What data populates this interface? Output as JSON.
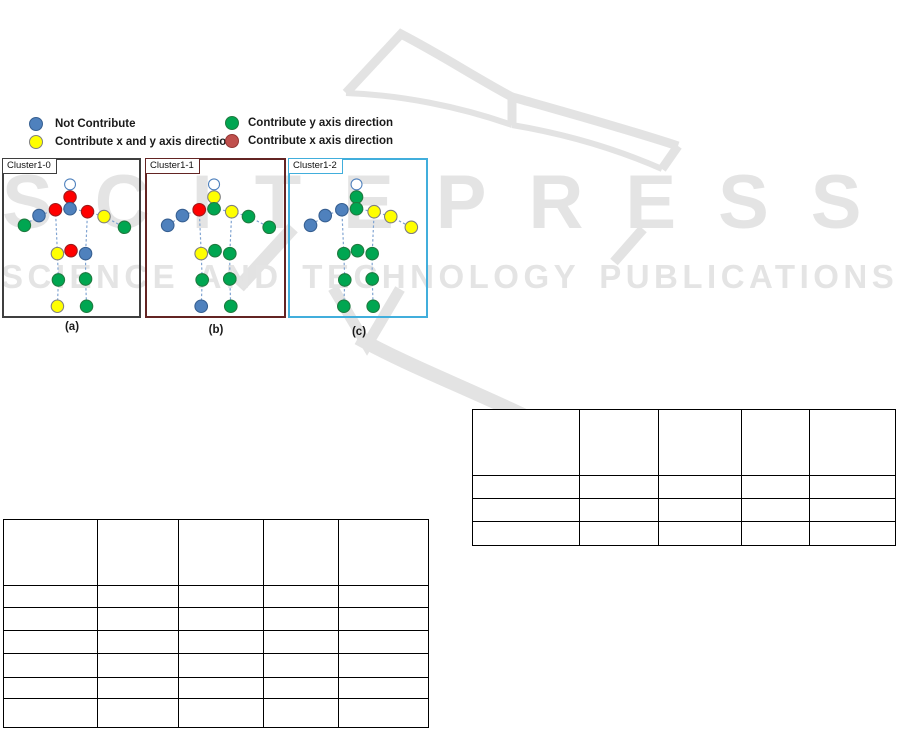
{
  "watermark": {
    "title": "SCITEPRESS",
    "subtitle": "SCIENCE AND TECHNOLOGY PUBLICATIONS",
    "color": "#E4E4E4"
  },
  "palette": {
    "blue": {
      "fill": "#4F81BD",
      "stroke": "#365F91"
    },
    "yellow": {
      "fill": "#FFFF00",
      "stroke": "#7F7F7F"
    },
    "green": {
      "fill": "#00A651",
      "stroke": "#1F7A3F"
    },
    "red": {
      "fill": "#FF0000",
      "stroke": "#9E1B1B"
    },
    "darkred": {
      "fill": "#C0504D",
      "stroke": "#943634"
    },
    "head": {
      "fill": "#FFFFFF",
      "stroke": "#4F81BD"
    }
  },
  "bone_color": "#7FA3D1",
  "legend": {
    "items": [
      {
        "key": "blue",
        "label": "Not Contribute"
      },
      {
        "key": "yellow",
        "label": "Contribute x and y axis direction"
      },
      {
        "key": "green",
        "label": "Contribute y axis direction"
      },
      {
        "key": "darkred",
        "label": "Contribute x axis direction"
      }
    ]
  },
  "clusters": [
    {
      "label": "Cluster1-0",
      "caption": "(a)",
      "border_color": "#3F3F3F",
      "joint_colors": {
        "head": "head",
        "neck": "red",
        "chest": "blue",
        "lsho": "red",
        "rsho": "red",
        "lelb": "blue",
        "lhand": "green",
        "relb": "yellow",
        "rhand": "green",
        "lhip": "yellow",
        "mhip": "red",
        "rhip": "blue",
        "lknee": "green",
        "rknee": "green",
        "lfoot": "yellow",
        "rfoot": "green"
      }
    },
    {
      "label": "Cluster1-1",
      "caption": "(b)",
      "border_color": "#632423",
      "joint_colors": {
        "head": "head",
        "neck": "yellow",
        "chest": "green",
        "lsho": "red",
        "rsho": "yellow",
        "lelb": "blue",
        "lhand": "blue",
        "relb": "green",
        "rhand": "green",
        "lhip": "yellow",
        "mhip": "green",
        "rhip": "green",
        "lknee": "green",
        "rknee": "green",
        "lfoot": "blue",
        "rfoot": "green"
      }
    },
    {
      "label": "Cluster1-2",
      "caption": "(c)",
      "border_color": "#41AEDC",
      "joint_colors": {
        "head": "head",
        "neck": "green",
        "chest": "green",
        "lsho": "blue",
        "rsho": "yellow",
        "lelb": "blue",
        "lhand": "blue",
        "relb": "yellow",
        "rhand": "yellow",
        "lhip": "green",
        "mhip": "green",
        "rhip": "green",
        "lknee": "green",
        "rknee": "green",
        "lfoot": "green",
        "rfoot": "green"
      }
    }
  ],
  "tables": {
    "left": {
      "cells": [
        [
          "",
          "",
          "",
          "",
          ""
        ],
        [
          "",
          "",
          "",
          "",
          ""
        ],
        [
          "",
          "",
          "",
          "",
          ""
        ],
        [
          "",
          "",
          "",
          "",
          ""
        ],
        [
          "",
          "",
          "",
          "",
          ""
        ],
        [
          "",
          "",
          "",
          "",
          ""
        ],
        [
          "",
          "",
          "",
          "",
          ""
        ]
      ]
    },
    "right": {
      "cells": [
        [
          "",
          "",
          "",
          "",
          ""
        ],
        [
          "",
          "",
          "",
          "",
          ""
        ],
        [
          "",
          "",
          "",
          "",
          ""
        ],
        [
          "",
          "",
          "",
          "",
          ""
        ]
      ]
    }
  }
}
